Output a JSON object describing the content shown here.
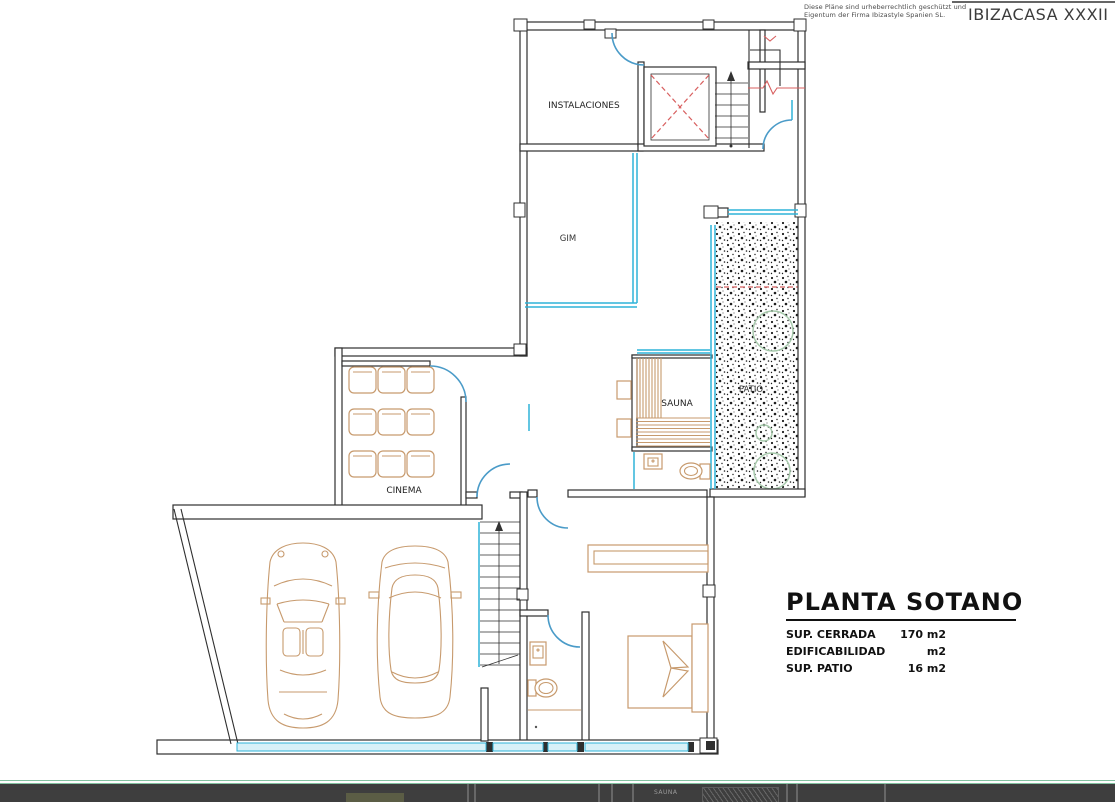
{
  "header": {
    "disclaimer_line1": "Diese Pläne sind urheberrechtlich geschützt und",
    "disclaimer_line2": "Eigentum der Firma Ibizastyle Spanien SL.",
    "project": "IBIZACASA XXXII"
  },
  "rooms": {
    "instalaciones": "INSTALACIONES",
    "gim": "GIM",
    "sauna": "SAUNA",
    "patio": "PATIO",
    "cinema": "CINEMA"
  },
  "title_block": {
    "title": "PLANTA SOTANO",
    "rows": [
      {
        "label": "SUP. CERRADA",
        "value": "170 m2"
      },
      {
        "label": "EDIFICABILIDAD",
        "value": "m2"
      },
      {
        "label": "SUP. PATIO",
        "value": "16 m2"
      }
    ]
  },
  "bottom_bar": {
    "sauna_label": "SAUNA"
  },
  "colors": {
    "wall": "#2f2f2f",
    "glass_cyan": "#2fb3d9",
    "glass_fill": "#d8f1f8",
    "door_blue": "#4a9bc8",
    "furniture_tan": "#c79a6d",
    "accent_red": "#d85f5f",
    "plant_green": "#a6c9ab",
    "separator_green": "#84c2a2",
    "bar_bg": "#3e3e3e"
  }
}
